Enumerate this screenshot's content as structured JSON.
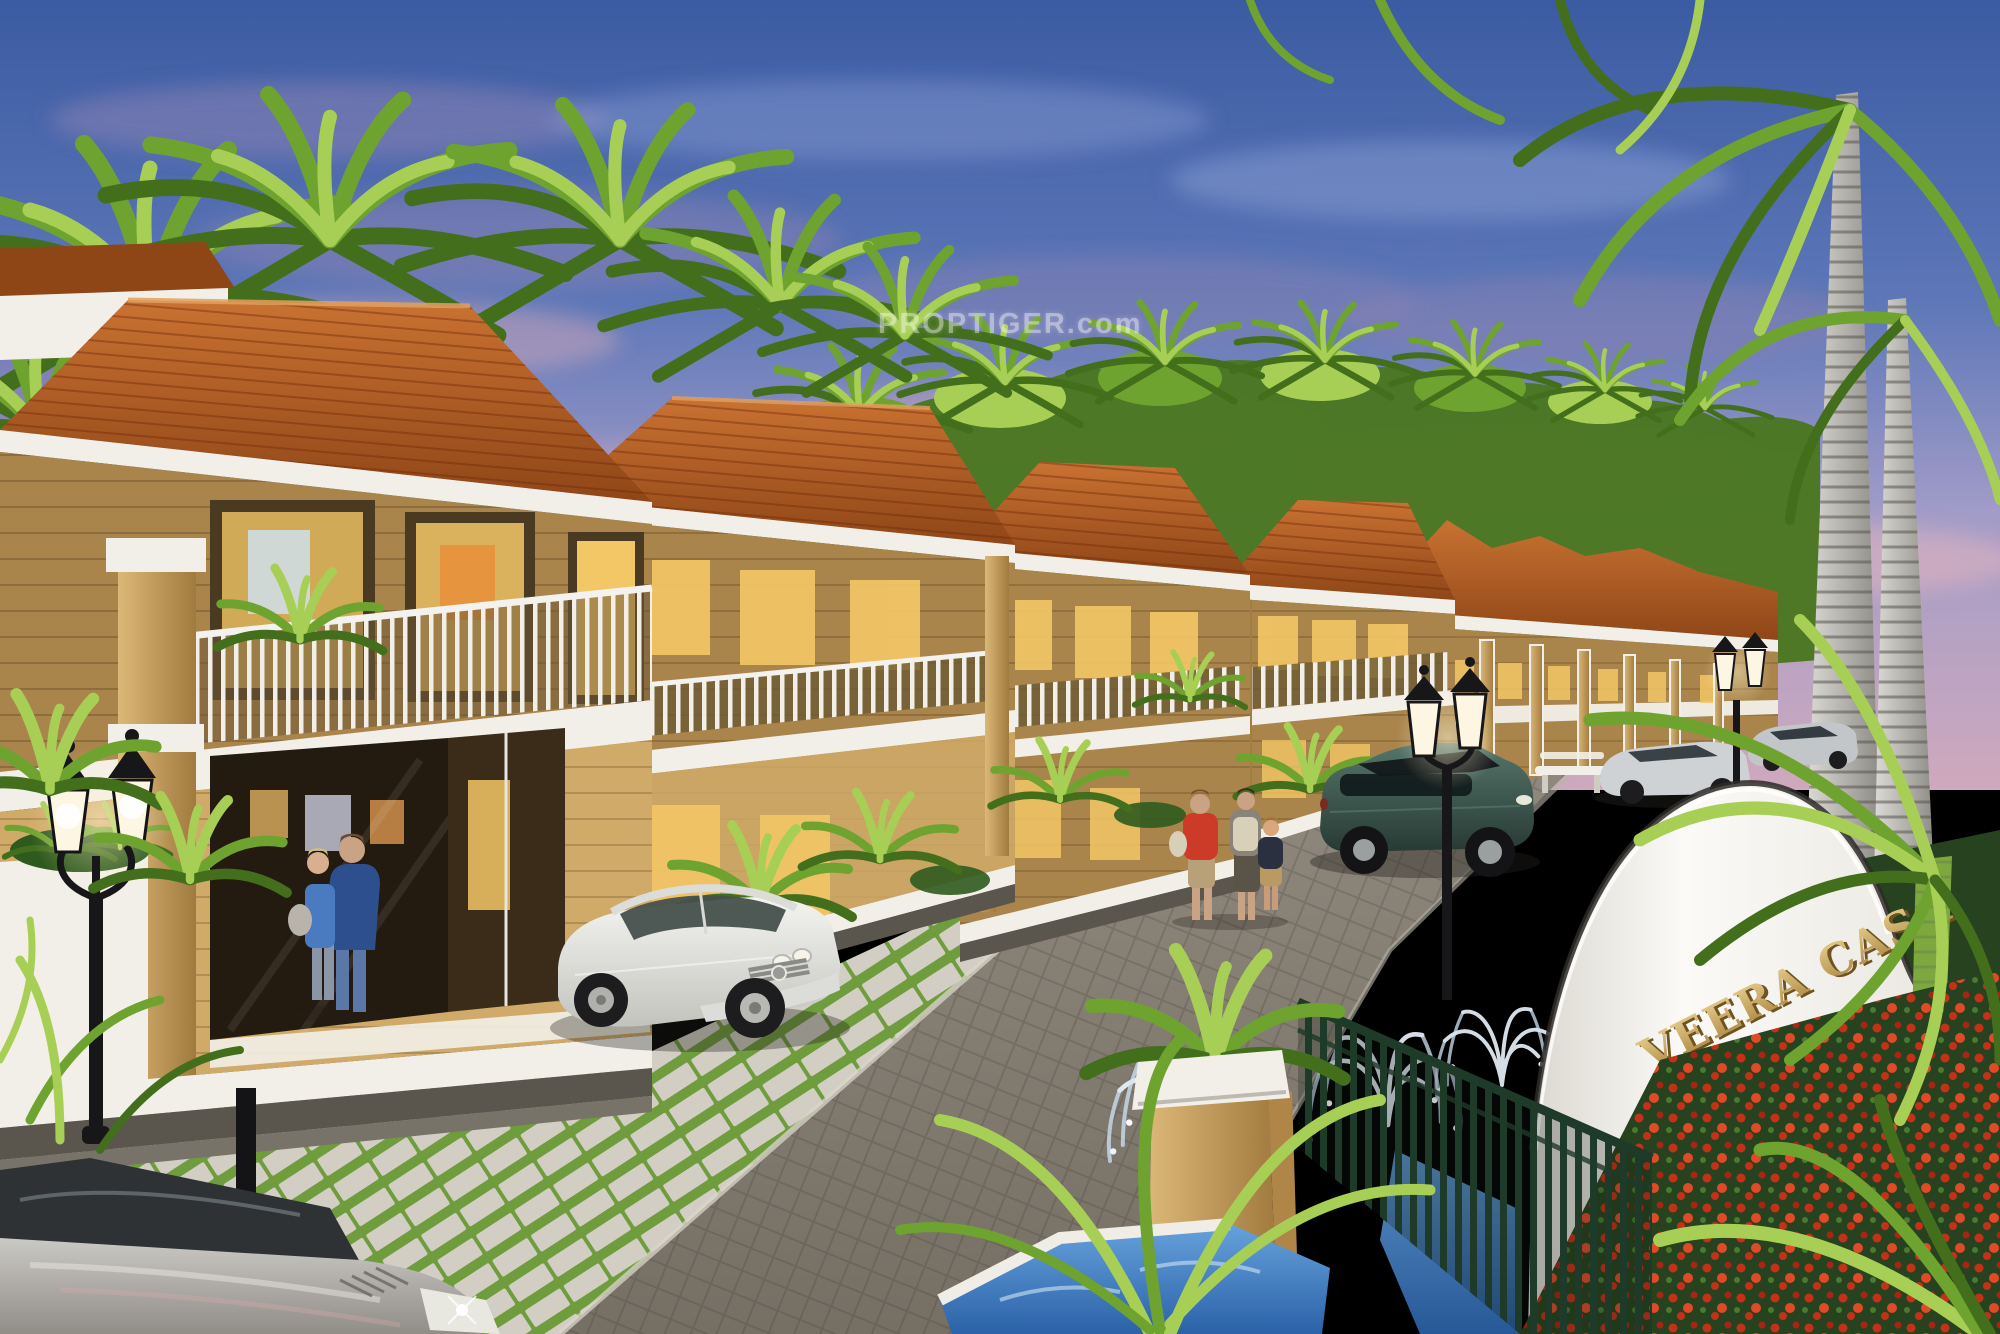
{
  "project": {
    "name_on_sign": "VEERA CASA"
  },
  "watermark": {
    "text": "PROPTIGER.com"
  },
  "entrance_sign": {
    "text": "VEERA CASA"
  },
  "palette": {
    "sky_top": "#3b5ba2",
    "sky_mid": "#5d77b8",
    "sky_lavender": "#a29cc8",
    "sky_pink": "#cfa9bd",
    "cloud_purple": "#8a82b2",
    "cloud_pink": "#dcaab8",
    "palm_light": "#a8cf55",
    "palm_mid": "#6fa32f",
    "palm_dark": "#436f1d",
    "roof_light": "#c97232",
    "roof_dark": "#8f4617",
    "wall_upper": "#a9854c",
    "wall_lower": "#d0aa68",
    "column_tan": "#c9a05c",
    "trim_white": "#f2efe8",
    "paver_grey": "#d2cec4",
    "grass_green": "#6f9c3c",
    "road_light": "#968f84",
    "road_dark": "#766f64",
    "suv_teal": "#3f5f55",
    "car_silver": "#e9e9e6",
    "fence_green": "#1e3a28",
    "flower_red": "#c53018",
    "hedge_green": "#27421e",
    "pool_light": "#66a2dc",
    "pool_dark": "#2b62a8",
    "gold_light": "#e9d193",
    "gold_dark": "#a8823a",
    "lamp_black": "#17171a",
    "window_warm": "#f3c766",
    "glow_warm": "#fff3cd"
  }
}
